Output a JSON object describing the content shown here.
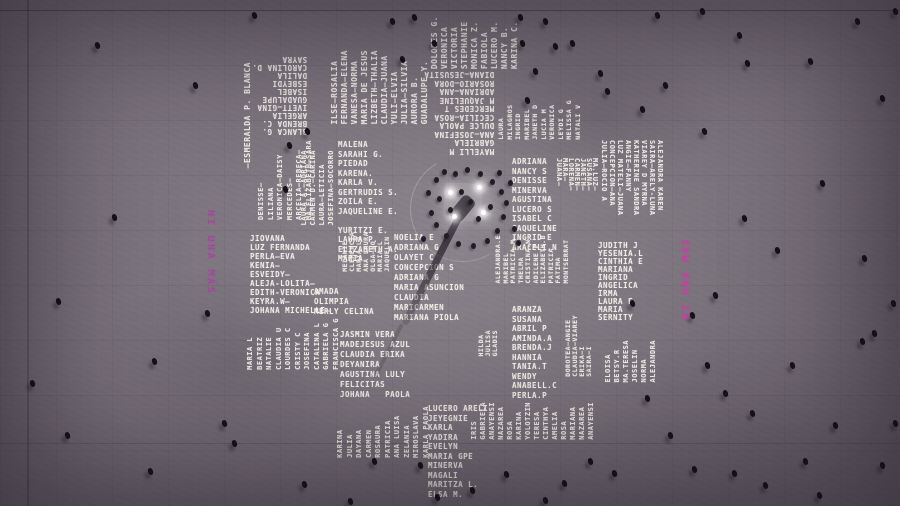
{
  "colors": {
    "pavement_gray": "#7b737c",
    "painted_name_white": "#f4efe9",
    "slogan_pink_bright": "#cd3ca2",
    "slogan_pink_faded": "#a0489c",
    "people_dark": "#17121a",
    "floodlight_white": "#ffffff"
  },
  "memorial": {
    "slogan_left": "NI UNA MÁS",
    "slogan_right": "NI UNA MÁS",
    "name_groups": [
      {
        "id": "top-left-inverted",
        "x": 252,
        "y": 55,
        "rot": 180,
        "fs": 7.5,
        "lh": 8,
        "names": [
          "BLANCA G.",
          "BRENDA C.",
          "ARGELIA",
          "IVETT—GINA",
          "GUADALUPE",
          "ISABEL",
          "ESBEYDI",
          "DALILA",
          "CAROLINA D.",
          "SAYRA"
        ]
      },
      {
        "id": "top-columns-left",
        "x": 330,
        "y": 50,
        "rot": -90,
        "fs": 8,
        "lh": 10,
        "names": [
          "ILSE—ROSALIA",
          "FERNANDA—ELENA",
          "VANESA—NORMA",
          "MARIA DE JESUS",
          "LIZBETH—THALIA",
          "CLAUDIA—JUANA",
          "YULI—ELVIA",
          "JULIA—SILVIA",
          "AURORA B.",
          "GUADALUPE Y."
        ]
      },
      {
        "id": "top-columns-mid",
        "x": 430,
        "y": 16,
        "rot": -90,
        "fs": 8,
        "lh": 10,
        "names": [
          "DOLORES G.",
          "VERONICA",
          "VICTORIA",
          "STEPHANIE",
          "MONICA Z.",
          "FABIOLA",
          "LUCERO M.",
          "NANCY B.",
          "KARINA C."
        ]
      },
      {
        "id": "left-edge-column",
        "x": 242,
        "y": 62,
        "rot": -90,
        "fs": 8,
        "lh": 11,
        "names": [
          "—ESMERALDA P. BLANCA"
        ]
      },
      {
        "id": "left-columns",
        "x": 257,
        "y": 140,
        "rot": -90,
        "fs": 7,
        "lh": 9.5,
        "names": [
          "DENISSE—",
          "LILIANA",
          "VERONICA—DAISY",
          "MERCEDES—",
          "ARCELIA—REBECA—",
          "MA.ELIZABETH—SARA"
        ]
      },
      {
        "id": "left-columns-2",
        "x": 300,
        "y": 150,
        "rot": -90,
        "fs": 7,
        "lh": 9,
        "names": [
          "LAURA A.—ADRIANA",
          "CARMEN D.—CARINA",
          "LAURA—LETICIA",
          "JOSEFINA—SOCORRO"
        ]
      },
      {
        "id": "left-rows",
        "x": 250,
        "y": 234,
        "rot": 0,
        "fs": 7.5,
        "lh": 9,
        "names": [
          "JIOVANA",
          "LUZ FERNANDA",
          "PERLA—EVA",
          "KENIA—",
          "ESVEIDY—",
          "ALEJA-LOLITA—",
          "EDITH-VERONICA",
          "KEYRA.W—",
          "JOHANA MICHELLE—"
        ]
      },
      {
        "id": "left-bottom-columns",
        "x": 246,
        "y": 318,
        "rot": -90,
        "fs": 7,
        "lh": 9.5,
        "names": [
          "MARIA L",
          "BEATRIZ",
          "NATALIE",
          "CLAUDIA U",
          "LOURDES C",
          "CRISTY C",
          "JOSEFINA",
          "CATALINA L",
          "GABRIELA G",
          "FRANCISCA G"
        ]
      },
      {
        "id": "midleft-rows",
        "x": 338,
        "y": 140,
        "rot": 0,
        "fs": 7.5,
        "lh": 9.5,
        "names": [
          "MALENA",
          "SARAHI G.",
          "PIEDAD",
          "KARENA.",
          "KARLA V.",
          "GERTRUDIS S.",
          "ZOILA E.",
          "JAQUELINE E.",
          " ",
          "YURITZI E.",
          "LAURA P.",
          "ELIZABETH A.",
          "MARIA"
        ]
      },
      {
        "id": "amada-rows",
        "x": 314,
        "y": 287,
        "rot": 0,
        "fs": 7.5,
        "lh": 10,
        "names": [
          "AMADA",
          "OLIMPIA",
          "MERLY CELINA"
        ]
      },
      {
        "id": "bottomleft-rows",
        "x": 340,
        "y": 330,
        "rot": 0,
        "fs": 7.5,
        "lh": 10,
        "names": [
          "JASMIN VERA",
          "MADEJESUS AZUL",
          "CLAUDIA ERIKA",
          "DEYANIRA",
          "AGUSTINA LULY",
          "FELICITAS",
          "JOHANA   PAOLA"
        ]
      },
      {
        "id": "bottom-columns",
        "x": 336,
        "y": 406,
        "rot": -90,
        "fs": 7,
        "lh": 9.5,
        "names": [
          "KARINA",
          "JULIA",
          "DAYANA",
          "CARMEN",
          "ROSAURA",
          "PATRICIA",
          "ANA LUISA",
          "ZELANIA",
          "MIROSLAVA",
          "KARLA PAOLA"
        ]
      },
      {
        "id": "bottom-rows",
        "x": 428,
        "y": 404,
        "rot": 0,
        "fs": 7.5,
        "lh": 9.5,
        "names": [
          "LUCERO ARELI",
          "JEYEGNIE",
          "KARLA",
          "YADIRA",
          "EVELYN",
          "MARIA GPE",
          "MINERVA",
          "MAGALI",
          "MARITZA L.",
          "ELSA M."
        ]
      },
      {
        "id": "bottom-right-columns",
        "x": 470,
        "y": 402,
        "rot": -90,
        "fs": 7,
        "lh": 9,
        "names": [
          "IRIS",
          "GABRIELA",
          "ANAYENSI",
          "NAZAREA",
          "ROSA",
          "KARINA",
          "YOLOTZIN",
          "TERESA",
          "CINTHYA",
          "AMELIA",
          "ROSA",
          "MARIANA",
          "NAZAREA",
          "ANAYENSI"
        ]
      },
      {
        "id": "right-lower-columns",
        "x": 604,
        "y": 340,
        "rot": -90,
        "fs": 7,
        "lh": 9,
        "names": [
          "ELOISA",
          "BETSY.R",
          "MA.TERESA",
          "JOSELIN",
          "NORMA",
          "ALEJANDRA"
        ]
      },
      {
        "id": "center-inverted",
        "x": 424,
        "y": 70,
        "rot": 180,
        "fs": 7.5,
        "lh": 8.5,
        "names": [
          "MAYELLI M",
          "GABRIELA",
          "ANA—JOSEFINA",
          "DULCE PAOLA",
          "CECILIA—ROSA",
          "MERCEDES T",
          "M JAQUELINE",
          "ADRIANA—ANA",
          "ROSARIO—DORA",
          "DIANA—JESUSITA"
        ]
      },
      {
        "id": "center-columns",
        "x": 497,
        "y": 100,
        "rot": -90,
        "fs": 6.5,
        "lh": 8.5,
        "names": [
          "LAURA",
          "MILAGROS",
          "INGRID",
          "MARIBEL",
          "JANETH D",
          "LUCIA M",
          "VERONICA",
          "LEYDI G",
          "MELISSA G",
          "NATALI V"
        ]
      },
      {
        "id": "center-right-rows",
        "x": 512,
        "y": 157,
        "rot": 0,
        "fs": 7.5,
        "lh": 9.5,
        "names": [
          "ADRIANA",
          "NANCY S",
          "DENISSE",
          "MINERVA",
          "AGUSTINA",
          "LUCERO S",
          "ISABEL C",
          "JAQUELINE",
          "INGRID E",
          "ARACELI.N"
        ]
      },
      {
        "id": "right-columns",
        "x": 600,
        "y": 140,
        "rot": 90,
        "fs": 7,
        "lh": 8,
        "names": [
          "ALEJANDRA KAREN",
          "SAIRA—ARELY-LUNA",
          "VIAREY D MYRNA",
          "KATHERINE SANDRA",
          "ANGIE—FANNY",
          "LUZ MATELI—JUANA",
          "CONCEPCION—ANA",
          "JULIA—ROCIO A"
        ]
      },
      {
        "id": "right-columns-short",
        "x": 556,
        "y": 158,
        "rot": 90,
        "fs": 7,
        "lh": 6,
        "names": [
          "MA.LUZ—",
          "SUSANA—",
          "JANETH—",
          "CARMEN—",
          "LORENA—",
          "MARA—",
          "JUANA—"
        ]
      },
      {
        "id": "center-left-rows",
        "x": 394,
        "y": 233,
        "rot": 0,
        "fs": 7.5,
        "lh": 10,
        "names": [
          "NOELIA E",
          "ADRIANA G",
          "OLAYET C",
          "CONCEPCION S",
          "ADRIANA G",
          "MARIA ASUNCION",
          "CLAUDIA",
          "MARICARMEN",
          "MARIANA PIOLA"
        ]
      },
      {
        "id": "center-columns-2",
        "x": 495,
        "y": 235,
        "rot": -90,
        "fs": 6.5,
        "lh": 7.5,
        "names": [
          "ALEJANDRA.E",
          "MARIBEL",
          "PATRICIA M",
          "THELMA",
          "CRISTINA.N",
          "ADILENE P",
          "ELIZABETH.B",
          "PATRICIA",
          "FATIMA",
          "MONTSERRAT"
        ]
      },
      {
        "id": "mid-rows",
        "x": 512,
        "y": 305,
        "rot": 0,
        "fs": 7.5,
        "lh": 9.5,
        "names": [
          "ARANZA",
          "SUSANA",
          "ABRIL P",
          "AMINDA.A",
          "BRENDA.J",
          "HANNIA",
          "TANIA.T",
          "WENDY",
          "ANABELL.C",
          "PERLA.P"
        ]
      },
      {
        "id": "right-mid-rows",
        "x": 598,
        "y": 242,
        "rot": 0,
        "fs": 7.5,
        "lh": 8,
        "names": [
          "JUDITH J",
          "YESENIA.L",
          "CINTHIA E",
          "MARIANA",
          "INGRID",
          "ANGELICA",
          "IRMA",
          "LAURA E",
          "MARIA",
          "SERNITY"
        ]
      },
      {
        "id": "mid-columns-thin",
        "x": 565,
        "y": 315,
        "rot": -90,
        "fs": 6.5,
        "lh": 7,
        "names": [
          "DOROTEA—ANGIE",
          "CLAUDIA—VIAREY",
          "ERIKA—I",
          "SAIRA—I"
        ]
      },
      {
        "id": "gladis-columns",
        "x": 478,
        "y": 330,
        "rot": -90,
        "fs": 6.5,
        "lh": 7,
        "names": [
          "HILDA",
          "JULISA",
          "GLADIS"
        ]
      },
      {
        "id": "midleft-columns-thin",
        "x": 342,
        "y": 232,
        "rot": -90,
        "fs": 6.5,
        "lh": 7,
        "names": [
          "MELANIE",
          "CLEMENCIA",
          "MARIA LO",
          "ANA LAURA",
          "OLGA—NO",
          "MARIA L",
          "JAQUELIN"
        ]
      }
    ]
  },
  "flagpole": {
    "lights": [
      [
        448,
        190
      ],
      [
        477,
        185
      ],
      [
        452,
        214
      ],
      [
        481,
        210
      ]
    ],
    "crowd": [
      [
        434,
        177
      ],
      [
        442,
        169
      ],
      [
        453,
        171
      ],
      [
        465,
        167
      ],
      [
        478,
        171
      ],
      [
        490,
        179
      ],
      [
        499,
        189
      ],
      [
        504,
        200
      ],
      [
        501,
        214
      ],
      [
        495,
        228
      ],
      [
        485,
        238
      ],
      [
        471,
        243
      ],
      [
        456,
        241
      ],
      [
        444,
        233
      ],
      [
        434,
        222
      ],
      [
        429,
        210
      ],
      [
        437,
        196
      ],
      [
        468,
        199
      ],
      [
        459,
        189
      ],
      [
        476,
        216
      ],
      [
        448,
        207
      ],
      [
        488,
        204
      ],
      [
        512,
        226
      ],
      [
        516,
        240
      ],
      [
        421,
        236
      ],
      [
        426,
        190
      ],
      [
        508,
        180
      ],
      [
        497,
        170
      ]
    ]
  },
  "people": [
    [
      95,
      42
    ],
    [
      193,
      82
    ],
    [
      252,
      12
    ],
    [
      287,
      142
    ],
    [
      283,
      186
    ],
    [
      305,
      128
    ],
    [
      390,
      18
    ],
    [
      400,
      56
    ],
    [
      412,
      14
    ],
    [
      432,
      40
    ],
    [
      518,
      14
    ],
    [
      520,
      40
    ],
    [
      543,
      18
    ],
    [
      553,
      43
    ],
    [
      533,
      68
    ],
    [
      525,
      97
    ],
    [
      570,
      40
    ],
    [
      605,
      88
    ],
    [
      598,
      70
    ],
    [
      640,
      106
    ],
    [
      663,
      82
    ],
    [
      700,
      8
    ],
    [
      737,
      32
    ],
    [
      745,
      60
    ],
    [
      808,
      58
    ],
    [
      855,
      18
    ],
    [
      880,
      95
    ],
    [
      893,
      8
    ],
    [
      702,
      128
    ],
    [
      742,
      215
    ],
    [
      775,
      247
    ],
    [
      690,
      312
    ],
    [
      713,
      292
    ],
    [
      820,
      180
    ],
    [
      862,
      255
    ],
    [
      891,
      300
    ],
    [
      872,
      330
    ],
    [
      705,
      362
    ],
    [
      723,
      390
    ],
    [
      750,
      410
    ],
    [
      790,
      362
    ],
    [
      803,
      458
    ],
    [
      833,
      422
    ],
    [
      860,
      338
    ],
    [
      645,
      395
    ],
    [
      668,
      432
    ],
    [
      692,
      466
    ],
    [
      732,
      470
    ],
    [
      763,
      482
    ],
    [
      817,
      492
    ],
    [
      880,
      462
    ],
    [
      893,
      420
    ],
    [
      418,
      462
    ],
    [
      435,
      494
    ],
    [
      470,
      487
    ],
    [
      504,
      471
    ],
    [
      543,
      497
    ],
    [
      562,
      480
    ],
    [
      588,
      458
    ],
    [
      612,
      470
    ],
    [
      65,
      432
    ],
    [
      148,
      468
    ],
    [
      232,
      440
    ],
    [
      302,
      481
    ],
    [
      348,
      498
    ],
    [
      372,
      458
    ],
    [
      152,
      358
    ],
    [
      112,
      214
    ],
    [
      56,
      298
    ],
    [
      30,
      380
    ],
    [
      205,
      310
    ],
    [
      222,
      420
    ],
    [
      630,
      300
    ],
    [
      655,
      12
    ]
  ]
}
